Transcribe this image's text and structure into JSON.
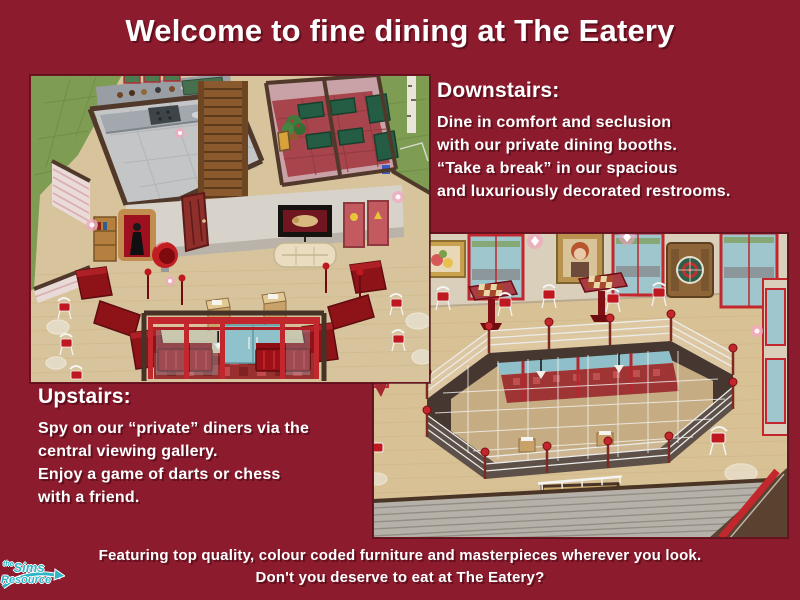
{
  "title": "Welcome to fine dining at The Eatery",
  "colors": {
    "background": "#8C1B2E",
    "text": "#FFFFFF",
    "logo_teal": "#2FB6C6",
    "accent_red": "#C1272D"
  },
  "sections": {
    "downstairs": {
      "heading": "Downstairs:",
      "lines": [
        "Dine in comfort and seclusion",
        "with our private dining booths.",
        "“Take a break” in our spacious",
        "and luxuriously decorated restrooms."
      ]
    },
    "upstairs": {
      "heading": "Upstairs:",
      "lines": [
        "Spy on our “private” diners via the",
        "central viewing gallery.",
        "Enjoy a game of darts or chess",
        "with a friend."
      ]
    }
  },
  "footer": {
    "lines": [
      "Featuring top quality, colour coded furniture and masterpieces wherever you look.",
      "Don't you deserve to eat at The Eatery?"
    ]
  },
  "logo": {
    "prefix": "the",
    "name": "Sims",
    "suffix": "Resource"
  }
}
